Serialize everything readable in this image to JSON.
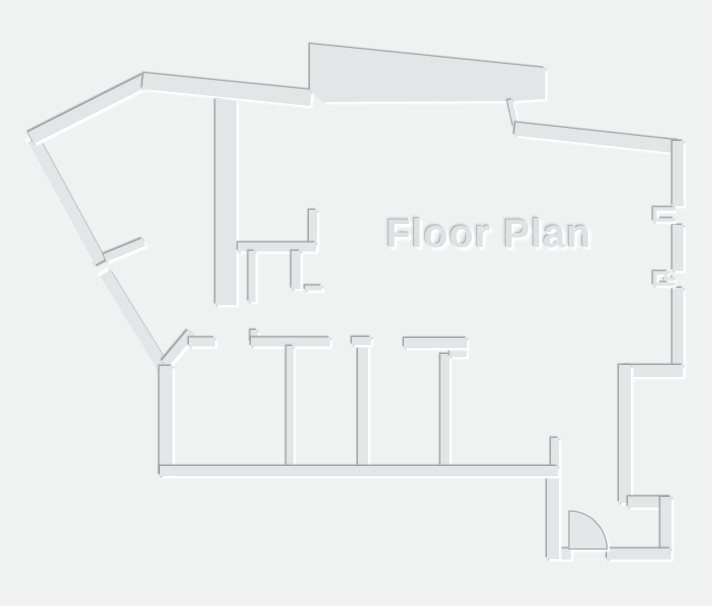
{
  "diagram": {
    "type": "floor-plan",
    "label": {
      "text": "Floor Plan",
      "x": 386,
      "y": 212,
      "font_size": 40,
      "color": "#dfe1e2"
    },
    "canvas": {
      "width": 712,
      "height": 606,
      "background": "#f0f1f1"
    },
    "colors": {
      "wall_fill": "#e3e5e6",
      "edge_dark": "#9fa1a3",
      "edge_light": "#ffffff",
      "door_fill": "#e4e6e7",
      "door_stroke": "#b2b4b6"
    },
    "walls_reverse_shade": [
      {
        "name": "outer-wall-diagonal-left-upper",
        "d": "M 33,139 L 100,262",
        "w": 12
      },
      {
        "name": "outer-wall-diagonal-left-lower",
        "d": "M 105,273 L 164,369",
        "w": 12
      }
    ],
    "walls_main": [
      {
        "name": "interior-wall-tall",
        "d": "M 226,99 L 226,305",
        "w": 21
      },
      {
        "name": "closet-wall-vertical",
        "d": "M 313,210 L 313,247",
        "w": 8
      },
      {
        "name": "closet-wall-horizontal",
        "d": "M 238,247 L 316,247",
        "w": 9
      },
      {
        "name": "closet-stub-left",
        "d": "M 252,251 L 252,302",
        "w": 7
      },
      {
        "name": "closet-stub-right",
        "d": "M 296,251 L 296,289",
        "w": 9
      },
      {
        "name": "closet-shelf",
        "d": "M 305,288 L 322,288",
        "w": 5
      },
      {
        "name": "outer-wall-diagonal-top",
        "d": "M 31,138 L 146,80",
        "w": 13
      },
      {
        "name": "interior-stub-diagonal",
        "d": "M 105,258 L 144,242",
        "w": 8
      },
      {
        "name": "roof-wall-left",
        "d": "M 143,81 L 311,98",
        "w": 16
      },
      {
        "name": "top-terrace-slab",
        "d": "M 310,44 L 545,68 L 545,99 L 512,101 L 324,102 L 310,90 Z",
        "w": 0,
        "fill": true
      },
      {
        "name": "step-connector",
        "d": "M 510,100 L 516,127",
        "w": 5
      },
      {
        "name": "roof-wall-right",
        "d": "M 515,129 L 679,147",
        "w": 13
      },
      {
        "name": "right-wall-upper",
        "d": "M 678,141 L 678,206",
        "w": 11
      },
      {
        "name": "right-wall-middle",
        "d": "M 678,225 L 678,271",
        "w": 11
      },
      {
        "name": "right-wall-lower",
        "d": "M 678,288 L 678,371",
        "w": 11
      },
      {
        "name": "window-jamb-upper",
        "d": "M 674,209 L 655,209 L 655,220 L 674,220",
        "w": 3.5
      },
      {
        "name": "window-jamb-lower",
        "d": "M 674,279 L 666,279 L 666,273 L 655,273 L 655,284 L 674,284",
        "w": 3.5
      },
      {
        "name": "step-wall-horizontal",
        "d": "M 683,371 L 625,371",
        "w": 12
      },
      {
        "name": "step-wall-vertical",
        "d": "M 625,365 L 625,503",
        "w": 12
      },
      {
        "name": "vestibule-wall-top",
        "d": "M 628,502 L 671,502",
        "w": 11
      },
      {
        "name": "vestibule-wall-right",
        "d": "M 666,497 L 666,554",
        "w": 11
      },
      {
        "name": "vestibule-wall-bottom",
        "d": "M 671,554 L 607,554",
        "w": 11
      },
      {
        "name": "door-hinge-stub",
        "d": "M 571,554 L 559,554",
        "w": 11
      },
      {
        "name": "entry-wall-left",
        "d": "M 553,559 L 553,467",
        "w": 12
      },
      {
        "name": "entry-stub-upper",
        "d": "M 555,438 L 555,468",
        "w": 8
      },
      {
        "name": "room1-wall-diagonal",
        "d": "M 165,364 L 191,333",
        "w": 9
      },
      {
        "name": "room1-wall-top",
        "d": "M 189,342 L 215,342",
        "w": 9
      },
      {
        "name": "partition1-cap-stub",
        "d": "M 254,330 L 254,342",
        "w": 7
      },
      {
        "name": "partition1-top-wall",
        "d": "M 251,342 L 330,342",
        "w": 9
      },
      {
        "name": "partition1",
        "d": "M 290,346 L 290,467",
        "w": 7
      },
      {
        "name": "partition2",
        "d": "M 363,345 L 363,467",
        "w": 10
      },
      {
        "name": "partition2-cap",
        "d": "M 352,341 L 371,341",
        "w": 8
      },
      {
        "name": "partition3",
        "d": "M 445,354 L 445,467",
        "w": 9
      },
      {
        "name": "partition3-top-jog",
        "d": "M 458,343 L 458,357",
        "w": 17
      },
      {
        "name": "partition3-top-wall",
        "d": "M 404,343 L 467,343",
        "w": 10
      },
      {
        "name": "outer-wall-left-vertical",
        "d": "M 166,475 L 166,366",
        "w": 13
      },
      {
        "name": "outer-wall-bottom",
        "d": "M 160,471 L 558,471",
        "w": 10
      }
    ],
    "door": {
      "hinge_x": 569,
      "hinge_y": 549,
      "radius": 38
    }
  }
}
